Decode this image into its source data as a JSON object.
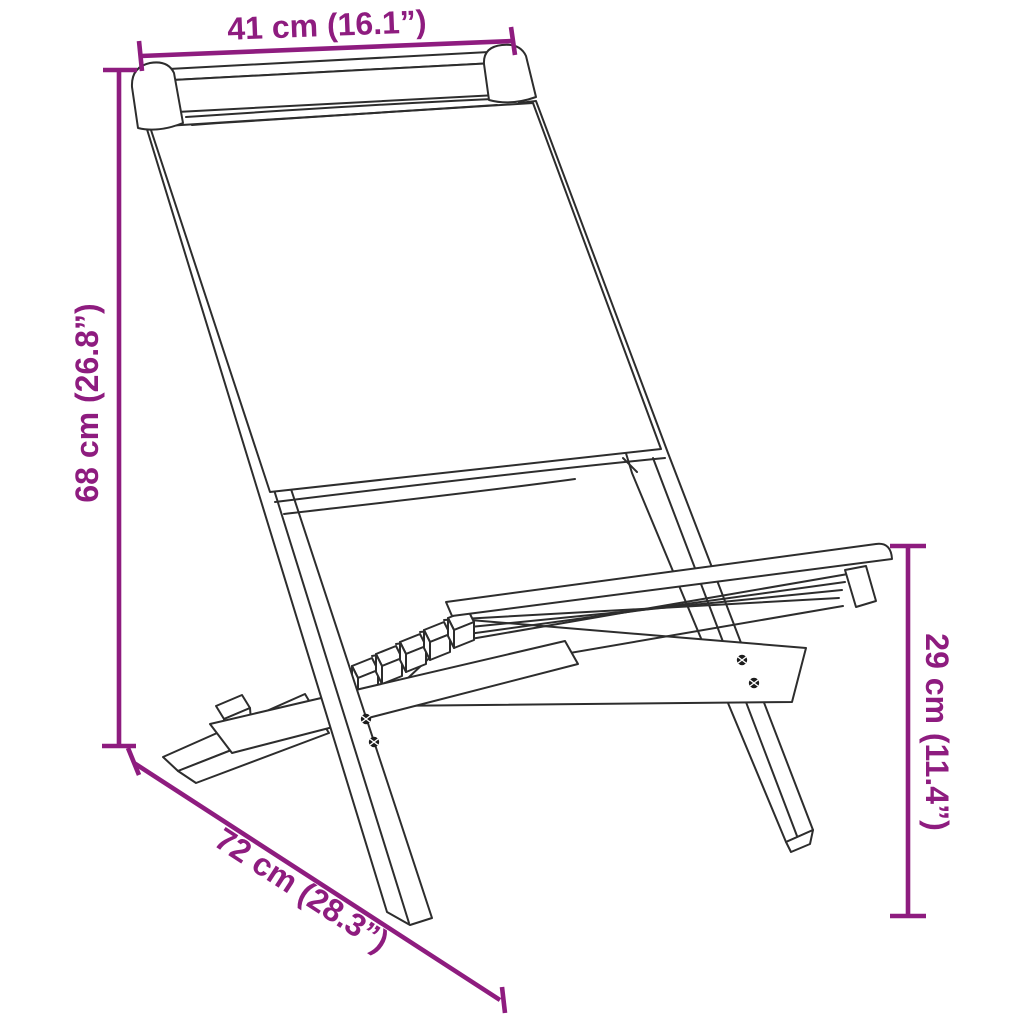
{
  "diagram": {
    "type": "product-dimension-line-drawing",
    "subject": "folding chair with fabric backrest and slatted wooden seat",
    "background_color": "#FFFFFF",
    "outline_color": "#2D2D2D",
    "dimension_color": "#8E1C7F",
    "dimensions": {
      "back_width": {
        "label": "41 cm (16.1”)",
        "cm": 41,
        "inches": 16.1,
        "placement": "top"
      },
      "total_height": {
        "label": "68 cm (26.8”)",
        "cm": 68,
        "inches": 26.8,
        "placement": "left"
      },
      "depth": {
        "label": "72 cm (28.3”)",
        "cm": 72,
        "inches": 28.3,
        "placement": "bottom-diagonal"
      },
      "seat_height": {
        "label": "29 cm (11.4”)",
        "cm": 29,
        "inches": 11.4,
        "placement": "right"
      }
    }
  }
}
